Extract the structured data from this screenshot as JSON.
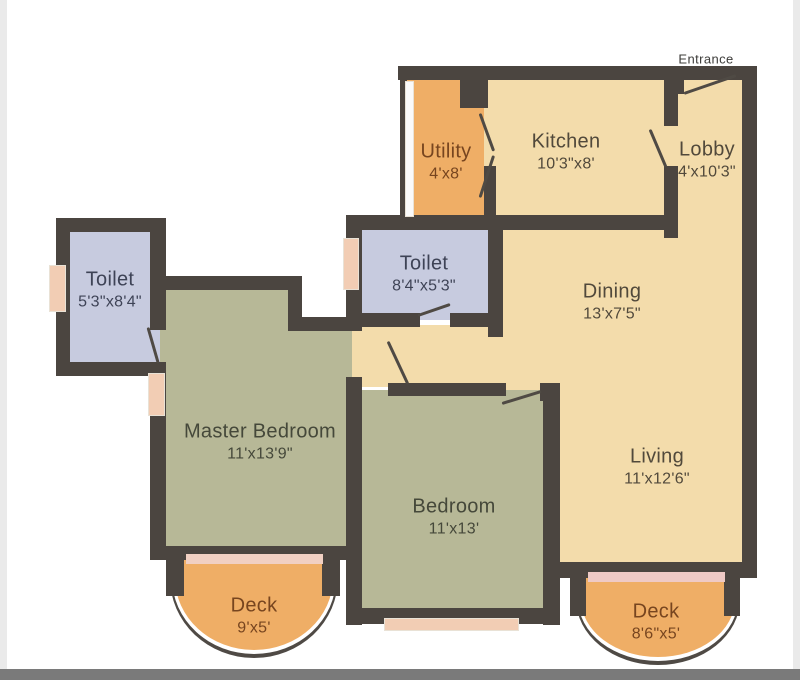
{
  "palette": {
    "wall": "#4b4540",
    "cream_room": "#f3dcab",
    "orange_room": "#efae66",
    "green_room": "#b7b897",
    "toilet_room": "#c7cbdf",
    "window": "#f2cdb4",
    "deck_door_strip": "#f1d0c3",
    "background": "#ffffff",
    "bottom_bar": "#7a7a7a"
  },
  "entrance_label": "Entrance",
  "rooms": {
    "utility": {
      "name": "Utility",
      "dims": "4'x8'"
    },
    "kitchen": {
      "name": "Kitchen",
      "dims": "10'3\"x8'"
    },
    "lobby": {
      "name": "Lobby",
      "dims": "4'x10'3\""
    },
    "toilet_master": {
      "name": "Toilet",
      "dims": "5'3\"x8'4\""
    },
    "toilet_common": {
      "name": "Toilet",
      "dims": "8'4\"x5'3\""
    },
    "dining": {
      "name": "Dining",
      "dims": "13'x7'5\""
    },
    "living": {
      "name": "Living",
      "dims": "11'x12'6\""
    },
    "master_bedroom": {
      "name": "Master Bedroom",
      "dims": "11'x13'9\""
    },
    "bedroom": {
      "name": "Bedroom",
      "dims": "11'x13'"
    },
    "deck_left": {
      "name": "Deck",
      "dims": "9'x5'"
    },
    "deck_right": {
      "name": "Deck",
      "dims": "8'6\"x5'"
    }
  }
}
